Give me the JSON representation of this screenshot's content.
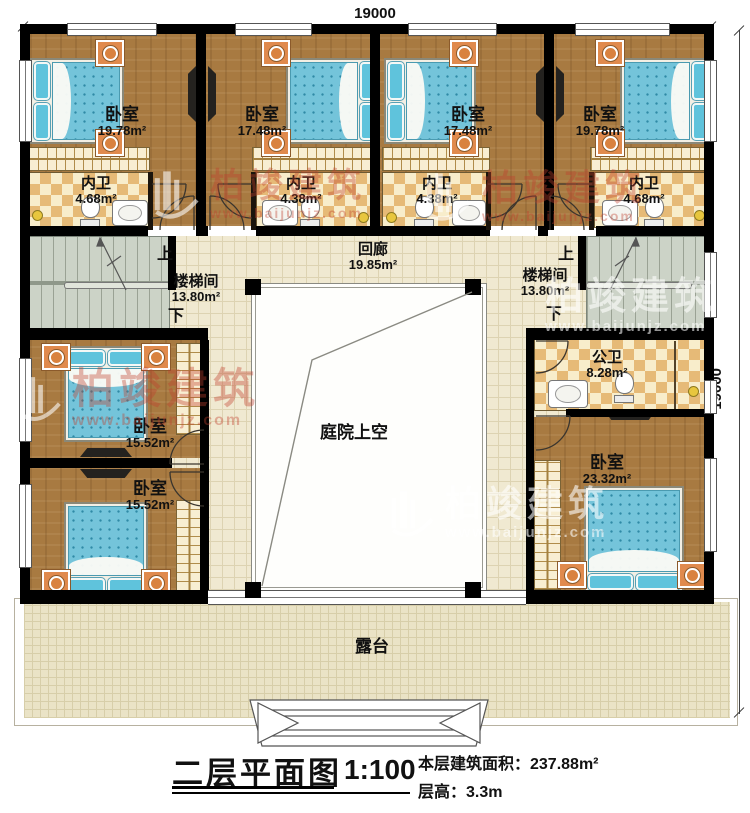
{
  "dims": {
    "top": "19000",
    "right": "19000"
  },
  "rooms": {
    "bedroom_tl": {
      "name": "卧室",
      "area": "19.78m²"
    },
    "bedroom_tml": {
      "name": "卧室",
      "area": "17.48m²"
    },
    "bedroom_tmr": {
      "name": "卧室",
      "area": "17.48m²"
    },
    "bedroom_tr": {
      "name": "卧室",
      "area": "19.78m²"
    },
    "bath_1": {
      "name": "内卫",
      "area": "4.68m²"
    },
    "bath_2": {
      "name": "内卫",
      "area": "4.38m²"
    },
    "bath_3": {
      "name": "内卫",
      "area": "4.38m²"
    },
    "bath_4": {
      "name": "内卫",
      "area": "4.68m²"
    },
    "corridor": {
      "name": "回廊",
      "area": "19.85m²"
    },
    "stair_left": {
      "name": "楼梯间",
      "area": "13.80m²",
      "up": "上",
      "down": "下"
    },
    "stair_right": {
      "name": "楼梯间",
      "area": "13.80m²",
      "up": "上",
      "down": "下"
    },
    "public_bath": {
      "name": "公卫",
      "area": "8.28m²"
    },
    "bedroom_ml": {
      "name": "卧室",
      "area": "15.52m²"
    },
    "bedroom_bl": {
      "name": "卧室",
      "area": "15.52m²"
    },
    "bedroom_br": {
      "name": "卧室",
      "area": "23.32m²"
    },
    "courtyard": {
      "name": "庭院上空"
    },
    "terrace": {
      "name": "露台"
    }
  },
  "title_block": {
    "title": "二层平面图",
    "scale": "1:100",
    "area_line": "本层建筑面积：237.88m²",
    "height_line": "层高：3.3m"
  },
  "watermark": {
    "brand": "柏竣建筑",
    "url": "www.baijunjz.com"
  }
}
